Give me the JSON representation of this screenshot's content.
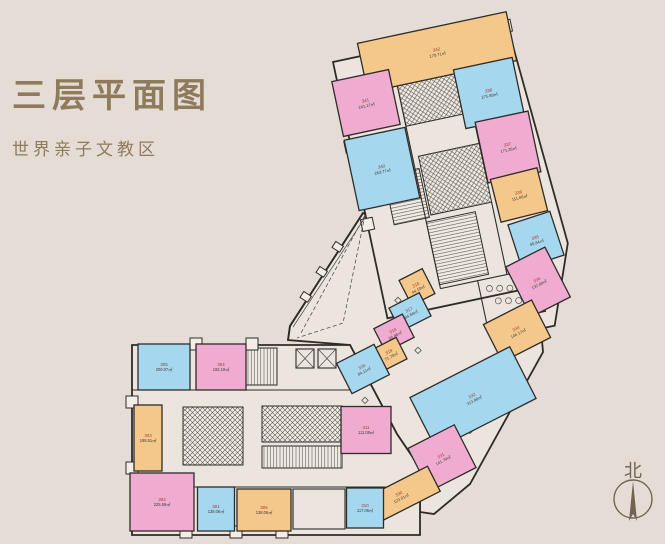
{
  "page": {
    "background": "#e5dcd6",
    "accent_text_color": "#8d7b5c"
  },
  "header": {
    "title": "三层平面图",
    "subtitle": "世界亲子文教区"
  },
  "compass": {
    "label": "北"
  },
  "plan": {
    "unit": "㎡",
    "wall_color": "#2e2c29",
    "floor_color": "#ece5de",
    "number_color": "#a03c36",
    "area_color": "#3f3d3a",
    "room_fills": {
      "orange": "#f4c78b",
      "pink": "#efabd0",
      "blue": "#a5d7ef"
    },
    "rooms": [
      {
        "no": "342",
        "area": "170.71㎡",
        "color": "orange",
        "cx": 437,
        "cy": 52,
        "w": 152,
        "h": 50,
        "rot": -12
      },
      {
        "no": "341",
        "area": "241.17㎡",
        "color": "pink",
        "cx": 366,
        "cy": 103,
        "w": 58,
        "h": 56,
        "rot": -12
      },
      {
        "no": "340",
        "area": "263.77㎡",
        "color": "blue",
        "cx": 382,
        "cy": 169,
        "w": 62,
        "h": 72,
        "rot": -12
      },
      {
        "no": "338",
        "area": "275.89㎡",
        "color": "blue",
        "cx": 489,
        "cy": 93,
        "w": 60,
        "h": 60,
        "rot": -12
      },
      {
        "no": "337",
        "area": "171.26㎡",
        "color": "pink",
        "cx": 508,
        "cy": 147,
        "w": 54,
        "h": 62,
        "rot": -12
      },
      {
        "no": "336",
        "area": "111.86㎡",
        "color": "orange",
        "cx": 519,
        "cy": 195,
        "w": 48,
        "h": 44,
        "rot": -14
      },
      {
        "no": "335",
        "area": "99.84㎡",
        "color": "blue",
        "cx": 536,
        "cy": 240,
        "w": 44,
        "h": 46,
        "rot": -18
      },
      {
        "no": "334",
        "area": "132.88㎡",
        "color": "pink",
        "cx": 538,
        "cy": 282,
        "w": 44,
        "h": 56,
        "rot": -27
      },
      {
        "no": "333",
        "area": "146.17㎡",
        "color": "orange",
        "cx": 517,
        "cy": 331,
        "w": 54,
        "h": 42,
        "rot": -27
      },
      {
        "no": "332",
        "area": "313.88㎡",
        "color": "blue",
        "cx": 473,
        "cy": 398,
        "w": 112,
        "h": 58,
        "rot": -27
      },
      {
        "no": "331",
        "area": "141.79㎡",
        "color": "pink",
        "cx": 442,
        "cy": 458,
        "w": 52,
        "h": 48,
        "rot": -27
      },
      {
        "no": "330",
        "area": "123.51㎡",
        "color": "orange",
        "cx": 400,
        "cy": 496,
        "w": 76,
        "h": 28,
        "rot": -27
      },
      {
        "no": "316",
        "area": "44.10㎡",
        "color": "orange",
        "cx": 417,
        "cy": 287,
        "w": 26,
        "h": 28,
        "rot": -27
      },
      {
        "no": "317",
        "area": "84.58㎡",
        "color": "blue",
        "cx": 410,
        "cy": 312,
        "w": 34,
        "h": 26,
        "rot": -27
      },
      {
        "no": "318",
        "area": "56.86㎡",
        "color": "pink",
        "cx": 394,
        "cy": 333,
        "w": 32,
        "h": 26,
        "rot": -27
      },
      {
        "no": "319",
        "area": "71.70㎡",
        "color": "orange",
        "cx": 390,
        "cy": 354,
        "w": 26,
        "h": 24,
        "rot": -27
      },
      {
        "no": "320",
        "area": "84.11㎡",
        "color": "blue",
        "cx": 363,
        "cy": 369,
        "w": 42,
        "h": 34,
        "rot": -27
      },
      {
        "no": "305",
        "area": "200.07㎡",
        "color": "blue",
        "cx": 164,
        "cy": 367,
        "w": 52,
        "h": 46,
        "rot": 0
      },
      {
        "no": "304",
        "area": "192.19㎡",
        "color": "pink",
        "cx": 221,
        "cy": 367,
        "w": 50,
        "h": 46,
        "rot": 0
      },
      {
        "no": "303",
        "area": "195.51㎡",
        "color": "orange",
        "cx": 148,
        "cy": 438,
        "w": 28,
        "h": 66,
        "rot": 0
      },
      {
        "no": "302",
        "area": "225.59㎡",
        "color": "pink",
        "cx": 162,
        "cy": 502,
        "w": 64,
        "h": 58,
        "rot": 0
      },
      {
        "no": "301",
        "area": "138.06㎡",
        "color": "blue",
        "cx": 216,
        "cy": 509,
        "w": 37,
        "h": 44,
        "rot": 0
      },
      {
        "no": "306",
        "area": "138.06㎡",
        "color": "orange",
        "cx": 264,
        "cy": 510,
        "w": 54,
        "h": 42,
        "rot": 0
      },
      {
        "no": "310",
        "area": "117.06㎡",
        "color": "blue",
        "cx": 365,
        "cy": 508,
        "w": 37,
        "h": 40,
        "rot": 0
      },
      {
        "no": "311",
        "area": "111.08㎡",
        "color": "pink",
        "cx": 366,
        "cy": 430,
        "w": 50,
        "h": 47,
        "rot": 0
      }
    ]
  }
}
